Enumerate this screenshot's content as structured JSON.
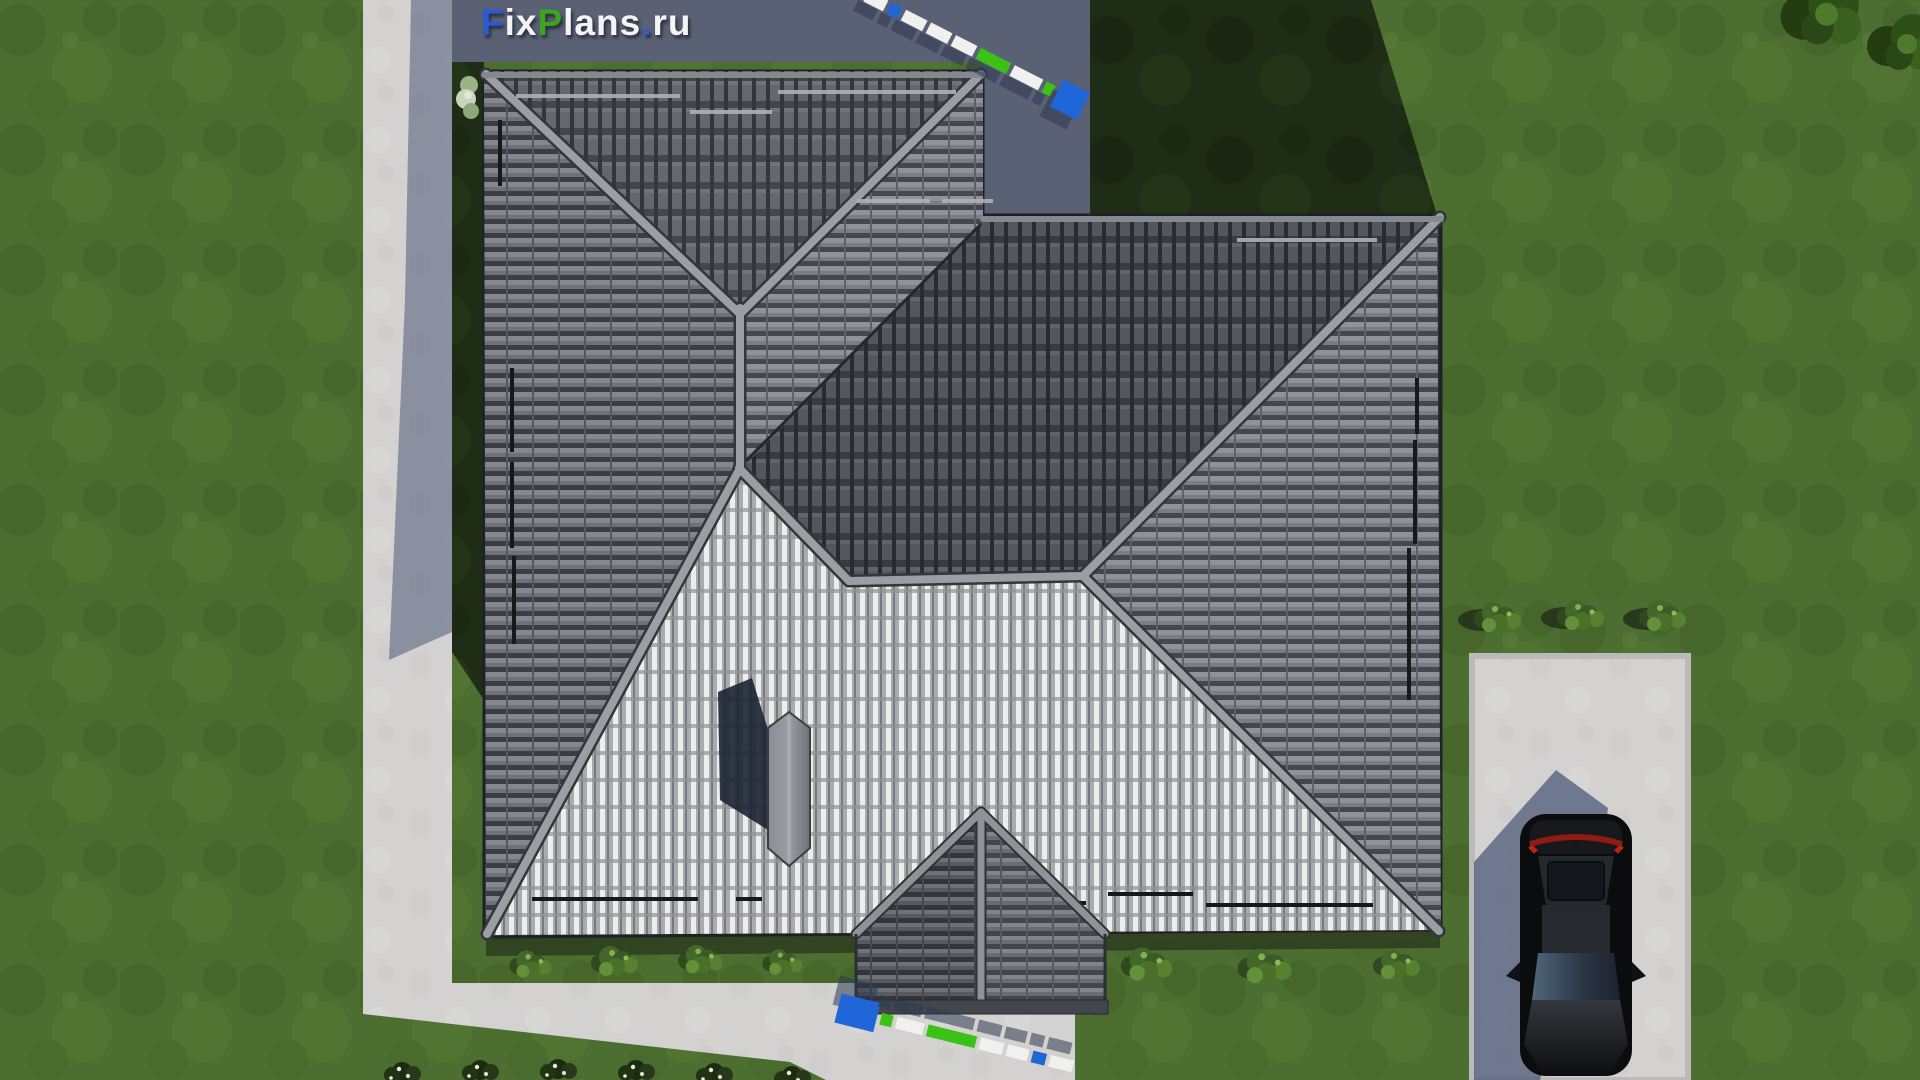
{
  "logo": {
    "parts": [
      {
        "text": "F",
        "color_key": "logo_blue"
      },
      {
        "text": "ix",
        "color_key": "logo_white"
      },
      {
        "text": "P",
        "color_key": "logo_green"
      },
      {
        "text": "lans",
        "color_key": "logo_white"
      },
      {
        "text": ".",
        "color_key": "logo_blue"
      },
      {
        "text": "ru",
        "color_key": "logo_white"
      }
    ]
  },
  "palette": {
    "logo_blue": "#2b5ad9",
    "logo_green": "#3aa51d",
    "logo_white": "#f3f4f6",
    "grass": "#4d6e31",
    "grass_shadow": "#1f2c16",
    "pavement": "#d3d2d0",
    "terrace_shadow": "#5a6175",
    "shadow_blue": "#4e5a78",
    "roof_dark": "#53565c",
    "roof_medium": "#6e7177",
    "roof_bright": "#c9cbcd",
    "ridge": "#9b9ea3",
    "rod_blue": "#1f66d8",
    "rod_green": "#3cc217",
    "rod_white": "#f0f0ee",
    "car_body": "#0b0c0e",
    "taillight": "#8f1b12",
    "pad": "#d2d1cf"
  },
  "rods": [
    {
      "name": "measuring-rod-top",
      "x": 866,
      "y": -4,
      "angle": 27,
      "shadow_dx": -5,
      "shadow_dy": 13,
      "segments": [
        {
          "c": "rod_white",
          "w": 22
        },
        {
          "c": "rod_blue",
          "w": 12
        },
        {
          "c": "rod_white",
          "w": 24
        },
        {
          "c": "rod_white",
          "w": 24
        },
        {
          "c": "rod_white",
          "w": 24
        },
        {
          "c": "rod_green",
          "w": 34
        },
        {
          "c": "rod_white",
          "w": 32
        },
        {
          "c": "rod_green",
          "w": 10
        },
        {
          "c": "rod_blue",
          "w": 30,
          "big": true
        }
      ]
    },
    {
      "name": "measuring-rod-bottom",
      "x": 838,
      "y": 1008,
      "angle": 14,
      "shadow_dx": -6,
      "shadow_dy": -17,
      "segments": [
        {
          "c": "rod_blue",
          "w": 40,
          "big": true
        },
        {
          "c": "rod_green",
          "w": 12
        },
        {
          "c": "rod_white",
          "w": 28
        },
        {
          "c": "rod_green",
          "w": 50
        },
        {
          "c": "rod_white",
          "w": 24
        },
        {
          "c": "rod_white",
          "w": 22
        },
        {
          "c": "rod_blue",
          "w": 14
        },
        {
          "c": "rod_white",
          "w": 24
        }
      ]
    }
  ],
  "objects": [
    "lawn",
    "house-roof",
    "porch-roof",
    "chimney",
    "walkway",
    "garden-path",
    "parking-pad",
    "car",
    "shrubs",
    "trees",
    "measuring-rod",
    "house-shadow"
  ]
}
